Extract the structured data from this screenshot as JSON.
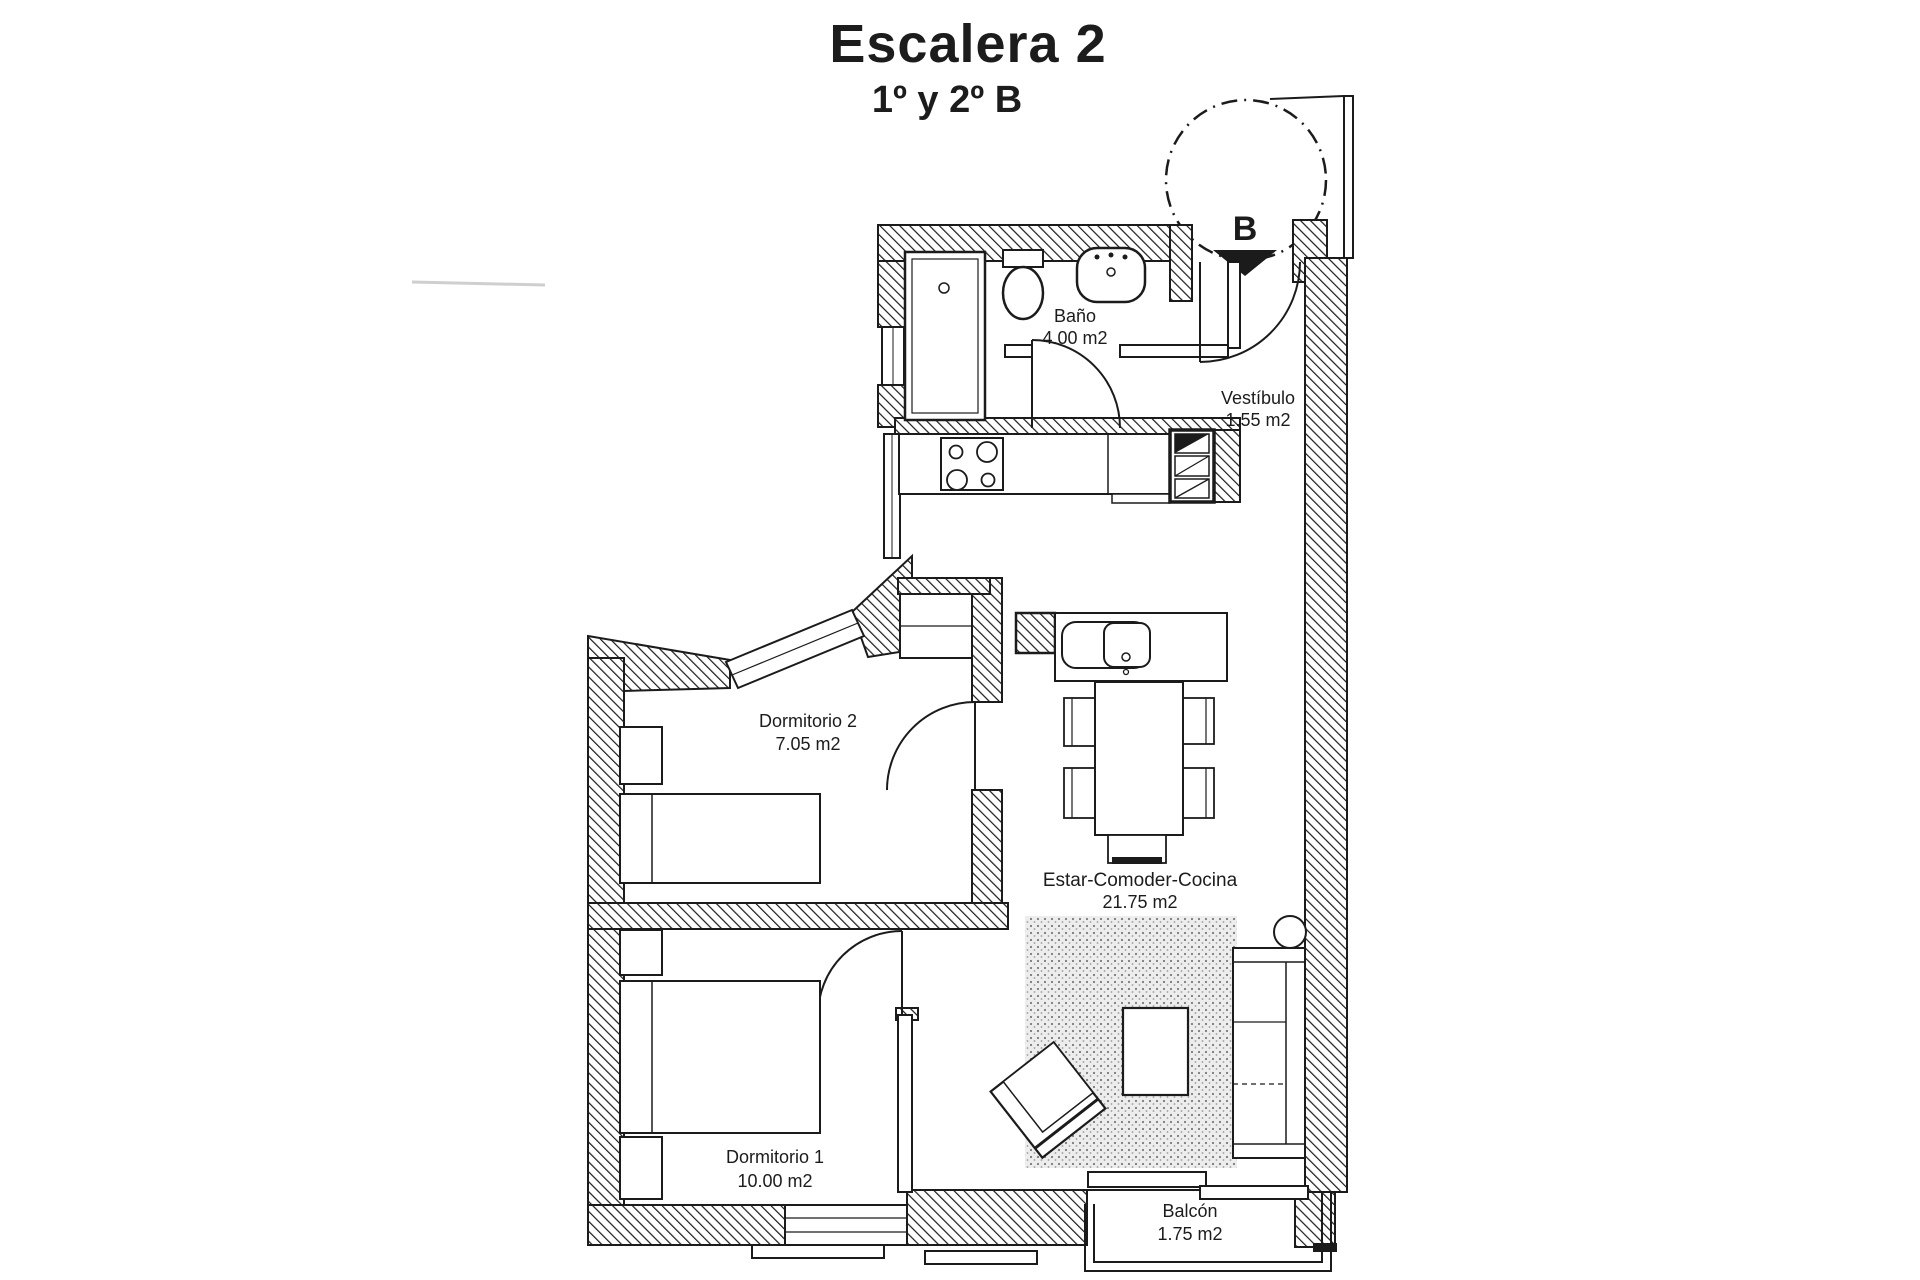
{
  "title": "Escalera 2",
  "subtitle": "1º y 2º B",
  "entrance": {
    "label": "B"
  },
  "rooms": {
    "bano": {
      "name": "Baño",
      "area": "4.00 m2"
    },
    "vestibulo": {
      "name": "Vestíbulo",
      "area": "1.55 m2"
    },
    "dormitorio2": {
      "name": "Dormitorio 2",
      "area": "7.05 m2"
    },
    "estar": {
      "name": "Estar-Comoder-Cocina",
      "area": "21.75 m2"
    },
    "dormitorio1": {
      "name": "Dormitorio 1",
      "area": "10.00 m2"
    },
    "balcon": {
      "name": "Balcón",
      "area": "1.75 m2"
    }
  },
  "colors": {
    "line": "#1b1b1b",
    "background": "#ffffff",
    "rug_dot": "#7a7a7a",
    "rug_base": "#ededed"
  }
}
